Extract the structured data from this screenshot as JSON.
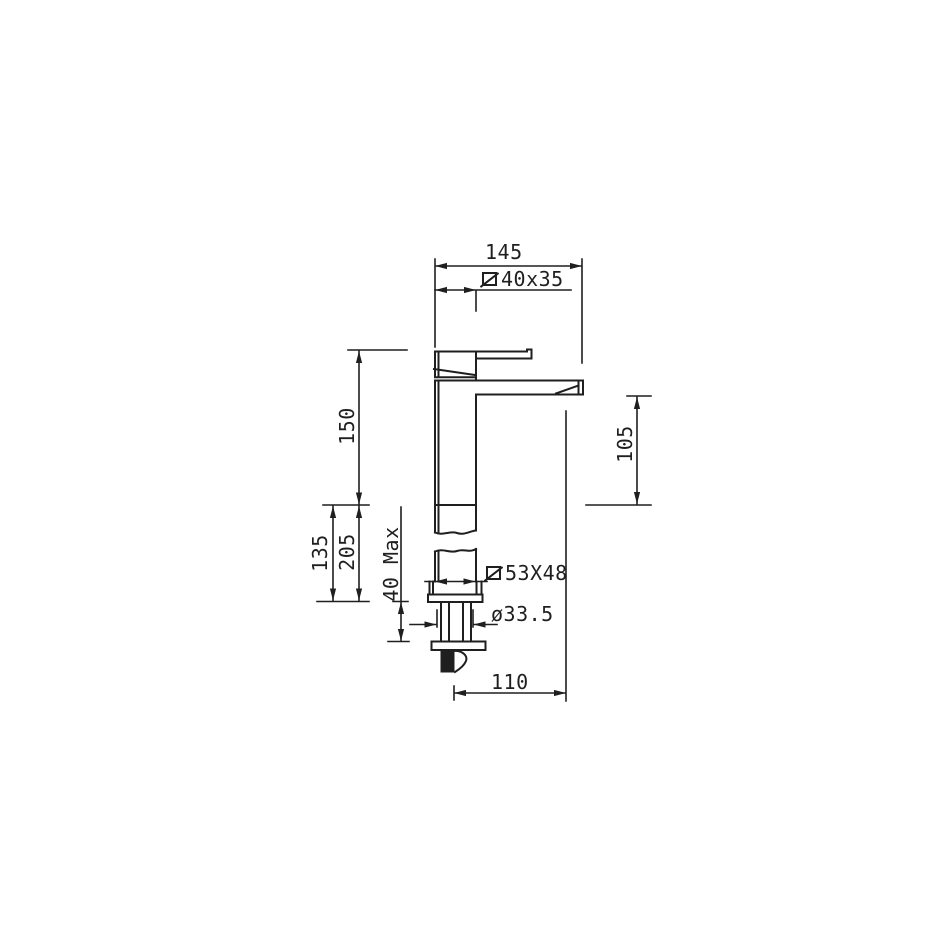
{
  "page": {
    "background": "#ffffff",
    "line_color": "#1f1f1f"
  },
  "labels": {
    "width_145": {
      "text": "145"
    },
    "section_40x35": {
      "text": "40x35",
      "symbol": "square-section"
    },
    "height_150": {
      "text": "150"
    },
    "height_105": {
      "text": "105"
    },
    "height_135": {
      "text": "135"
    },
    "height_205": {
      "text": "205"
    },
    "max_thickness_40": {
      "text": "40 Max"
    },
    "section_53x48": {
      "text": "53X48",
      "symbol": "square-section"
    },
    "diameter_33_5": {
      "text": "ø33.5"
    },
    "depth_110": {
      "text": "110"
    }
  }
}
